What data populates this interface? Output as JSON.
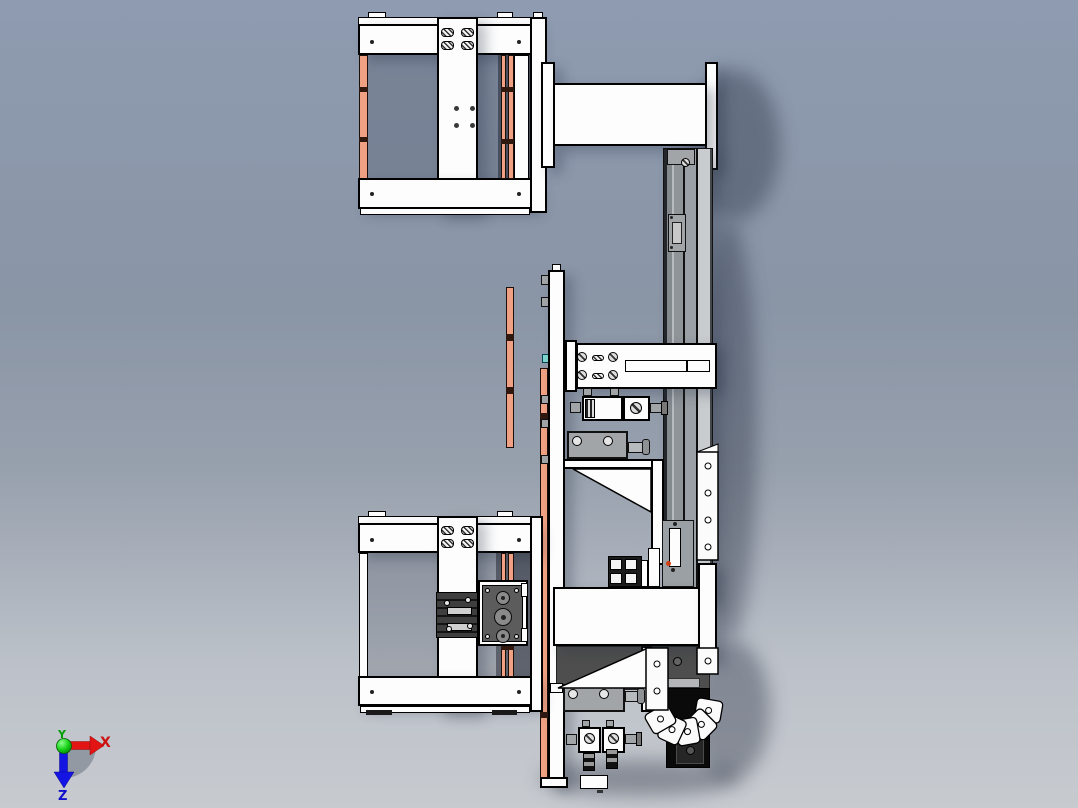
{
  "app": {
    "name": "cad-viewport",
    "view": "side-orthographic-view"
  },
  "triad": {
    "x_label": "X",
    "y_label": "Y",
    "z_label": "Z",
    "x_color": "#cc1111",
    "y_color": "#00a000",
    "z_color": "#1111cc"
  },
  "colors": {
    "background_top": "#8e9bb0",
    "background_bottom": "#c7cacf",
    "part_white": "#fdfdfd",
    "outline": "#000000",
    "copper_strip": "#f0a183",
    "rail_gray": "#9aa0a5",
    "dark_metal": "#4c4c4c",
    "cyan_accent": "#7fd4cc",
    "orange_indicator": "#d04010"
  },
  "parts": {
    "upper_frame": "upper clamp frame",
    "lower_frame": "lower clamp frame",
    "upper_plate": "upper mounting plate",
    "lower_plate": "lower mounting plate",
    "rail": "vertical linear rail",
    "arm": "carriage arm",
    "gripper": "pneumatic gripper",
    "chain": "cable carrier chain",
    "cylinder_mid": "air cylinder (middle)",
    "cylinder_low": "air cylinder (lower)",
    "valves": "pneumatic valve blocks",
    "sensor_strip": "sensor strip",
    "triad": "orientation triad"
  }
}
